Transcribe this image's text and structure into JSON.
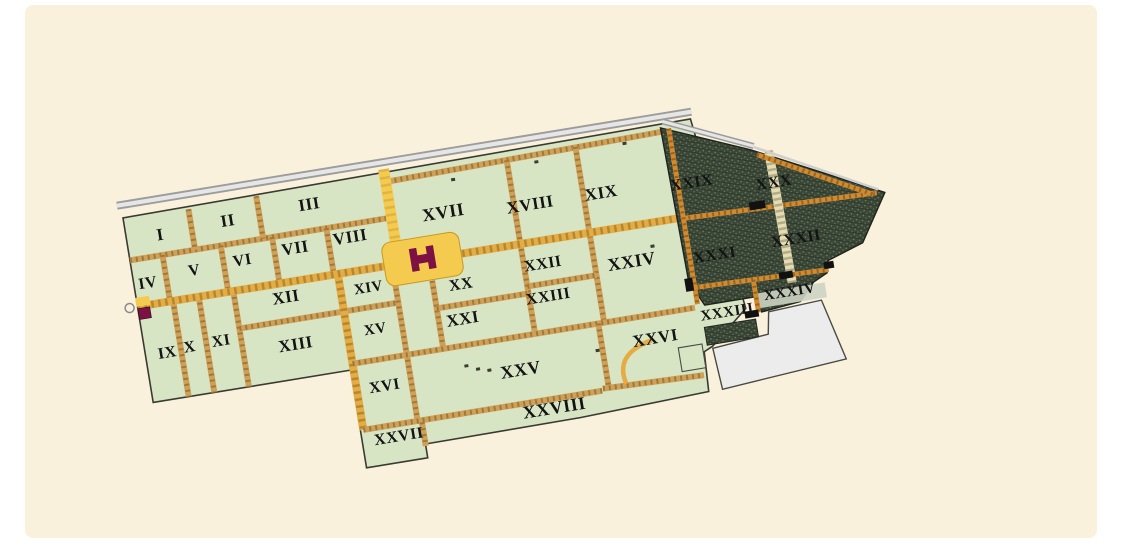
{
  "canvas": {
    "background": "#ffffff",
    "panel_color": "#faf1dc"
  },
  "map": {
    "type": "city-plan",
    "regions": [
      {
        "label": "I",
        "x": 34,
        "y": 34,
        "zone": "green",
        "size": 17
      },
      {
        "label": "II",
        "x": 103,
        "y": 31,
        "zone": "green",
        "size": 17
      },
      {
        "label": "III",
        "x": 186,
        "y": 28,
        "zone": "green",
        "size": 17
      },
      {
        "label": "IV",
        "x": 14,
        "y": 79,
        "zone": "green",
        "size": 16
      },
      {
        "label": "V",
        "x": 62,
        "y": 74,
        "zone": "green",
        "size": 16
      },
      {
        "label": "VI",
        "x": 111,
        "y": 72,
        "zone": "green",
        "size": 16
      },
      {
        "label": "VII",
        "x": 165,
        "y": 69,
        "zone": "green",
        "size": 17
      },
      {
        "label": "VIII",
        "x": 221,
        "y": 67,
        "zone": "green",
        "size": 17
      },
      {
        "label": "IX",
        "x": 22,
        "y": 151,
        "zone": "green",
        "size": 16
      },
      {
        "label": "X",
        "x": 45,
        "y": 149,
        "zone": "green",
        "size": 16
      },
      {
        "label": "XI",
        "x": 77,
        "y": 148,
        "zone": "green",
        "size": 16
      },
      {
        "label": "XII",
        "x": 148,
        "y": 116,
        "zone": "green",
        "size": 17
      },
      {
        "label": "XIII",
        "x": 150,
        "y": 164,
        "zone": "green",
        "size": 17
      },
      {
        "label": "XIV",
        "x": 231,
        "y": 119,
        "zone": "green",
        "size": 15
      },
      {
        "label": "XV",
        "x": 231,
        "y": 161,
        "zone": "green",
        "size": 15
      },
      {
        "label": "XVI",
        "x": 231,
        "y": 219,
        "zone": "green",
        "size": 16
      },
      {
        "label": "XVII",
        "x": 317,
        "y": 58,
        "zone": "green",
        "size": 18
      },
      {
        "label": "XVIII",
        "x": 404,
        "y": 64,
        "zone": "green",
        "size": 17
      },
      {
        "label": "XIX",
        "x": 476,
        "y": 64,
        "zone": "green",
        "size": 17
      },
      {
        "label": "XX",
        "x": 323,
        "y": 131,
        "zone": "green",
        "size": 16
      },
      {
        "label": "XXI",
        "x": 319,
        "y": 166,
        "zone": "green",
        "size": 17
      },
      {
        "label": "XXII",
        "x": 407,
        "y": 124,
        "zone": "green",
        "size": 16
      },
      {
        "label": "XXIII",
        "x": 407,
        "y": 157,
        "zone": "green",
        "size": 16
      },
      {
        "label": "XXIV",
        "x": 495,
        "y": 137,
        "zone": "green",
        "size": 18
      },
      {
        "label": "XXV",
        "x": 368,
        "y": 226,
        "zone": "green",
        "size": 18
      },
      {
        "label": "XXVI",
        "x": 506,
        "y": 216,
        "zone": "green",
        "size": 17
      },
      {
        "label": "XXVII",
        "x": 237,
        "y": 271,
        "zone": "green",
        "size": 16
      },
      {
        "label": "XXVIII",
        "x": 395,
        "y": 269,
        "zone": "green",
        "size": 18
      },
      {
        "label": "XXIX",
        "x": 567,
        "y": 68,
        "zone": "dark",
        "size": 16
      },
      {
        "label": "XXX",
        "x": 648,
        "y": 81,
        "zone": "dark",
        "size": 16
      },
      {
        "label": "XXXI",
        "x": 578,
        "y": 143,
        "zone": "dark",
        "size": 16
      },
      {
        "label": "XXXII",
        "x": 661,
        "y": 140,
        "zone": "dark",
        "size": 16
      },
      {
        "label": "XXXIII",
        "x": 581,
        "y": 201,
        "zone": "green",
        "size": 15
      },
      {
        "label": "XXXIV",
        "x": 646,
        "y": 191,
        "zone": "dark",
        "size": 15
      }
    ],
    "landmarks": [
      {
        "name": "h-shaped-building",
        "color": "#7d1144"
      },
      {
        "name": "forum-plaza",
        "color": "#f5cb4f"
      },
      {
        "name": "west-gate-marker",
        "color": "#7d1144"
      },
      {
        "name": "city-wall",
        "color": "#b8b8b8"
      },
      {
        "name": "unexcavated-district",
        "color": "#46523f"
      },
      {
        "name": "modern-block",
        "color": "#ececec"
      }
    ],
    "colors": {
      "block_green": "#d7e5c5",
      "road_tan": "#cfa057",
      "road_main": "#e4ac42",
      "road_dash": "#7a5a22",
      "road_orange": "#d08a30",
      "road_light": "#e6dcb2",
      "yellow": "#f5cb4f",
      "maroon": "#7d1144",
      "dark_fill": "#3a4636",
      "dark_hatch": "#76856c",
      "white_block": "#ececec",
      "outline": "#3a3a32",
      "label_color": "#131313",
      "wall_gray": "#9c9c9c",
      "wall_light": "#e6e6e6"
    }
  }
}
